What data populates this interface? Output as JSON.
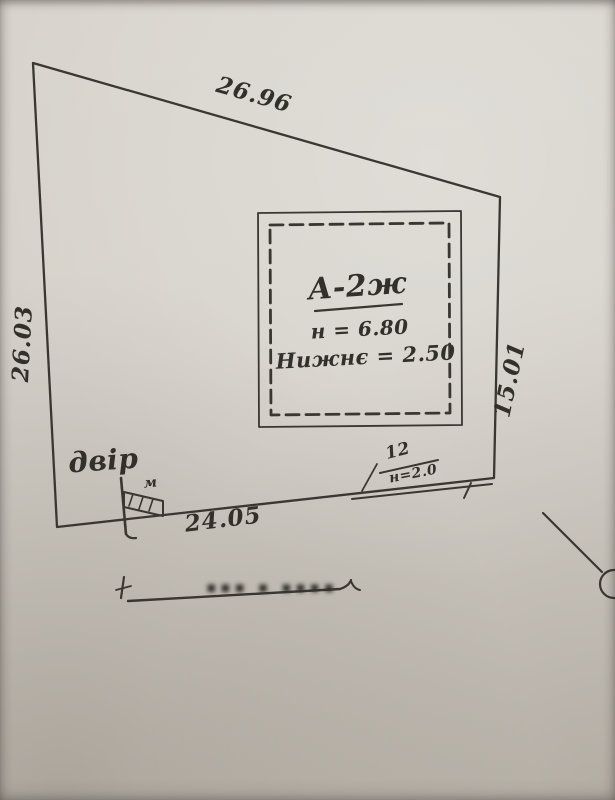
{
  "colors": {
    "paper": "#d5d1c9",
    "ink": "#3a3732"
  },
  "plot": {
    "side_top": "26.96",
    "side_left": "26.03",
    "side_right": "15.01",
    "side_bottom": "24.05",
    "yard_label": "двір",
    "gate_mark": "м",
    "fence_number": "12",
    "fence_height": "н=2.0"
  },
  "building": {
    "designation": "А-2ж",
    "height_note": "н = 6.80",
    "second_note": "Нижнє = 2.50"
  },
  "footer": {
    "blurred_label": "▪▪▪ ▪ ▪▪▪▪"
  }
}
